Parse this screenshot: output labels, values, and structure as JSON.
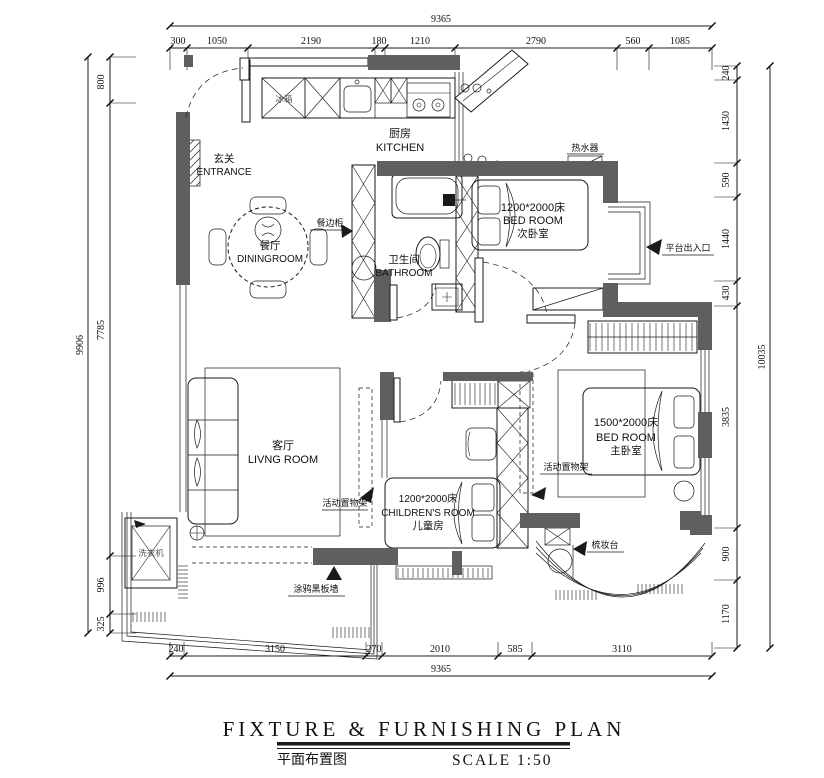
{
  "title": {
    "en": "FIXTURE & FURNISHING PLAN",
    "zh": "平面布置图",
    "scale": "SCALE 1:50"
  },
  "dimensions": {
    "top": {
      "total": "9365",
      "segments": [
        "300",
        "1050",
        "2190",
        "180",
        "1210",
        "2790",
        "560",
        "1085"
      ]
    },
    "bottom": {
      "total": "9365",
      "segments": [
        "240",
        "3150",
        "270",
        "2010",
        "585",
        "3110"
      ]
    },
    "left": {
      "total": "9906",
      "segments": [
        "800",
        "7785",
        "996",
        "325"
      ]
    },
    "right": {
      "total": "10035",
      "segments": [
        "240",
        "1430",
        "590",
        "1440",
        "430",
        "3835",
        "900",
        "1170"
      ]
    }
  },
  "rooms": {
    "entrance": {
      "zh": "玄关",
      "en": "ENTRANCE"
    },
    "kitchen": {
      "zh": "厨房",
      "en": "KITCHEN"
    },
    "dining": {
      "zh": "餐厅",
      "en": "DININGROOM"
    },
    "bathroom": {
      "zh": "卫生间",
      "en": "BATHROOM"
    },
    "bedroom2": {
      "bed": "1200*2000床",
      "en": "BED ROOM",
      "zh": "次卧室"
    },
    "living": {
      "zh": "客厅",
      "en": "LIVNG ROOM"
    },
    "children": {
      "bed": "1200*2000床",
      "en": "CHILDREN'S ROOM",
      "zh": "儿童房"
    },
    "master": {
      "bed": "1500*2000床",
      "en": "BED ROOM",
      "zh": "主卧室"
    }
  },
  "annotations": {
    "fridge": "冰箱",
    "sideboard": "餐边柜",
    "water_heater": "热水器",
    "platform_entry": "平台出入口",
    "shelf_left": "活动置物架",
    "shelf_right": "活动置物架",
    "washing_machine": "洗衣机",
    "blackboard_wall": "涂鸦黑板墙",
    "dresser": "梳妆台"
  },
  "colors": {
    "wall": "#5f5f5f",
    "line": "#1a1a1a",
    "background": "#ffffff"
  }
}
